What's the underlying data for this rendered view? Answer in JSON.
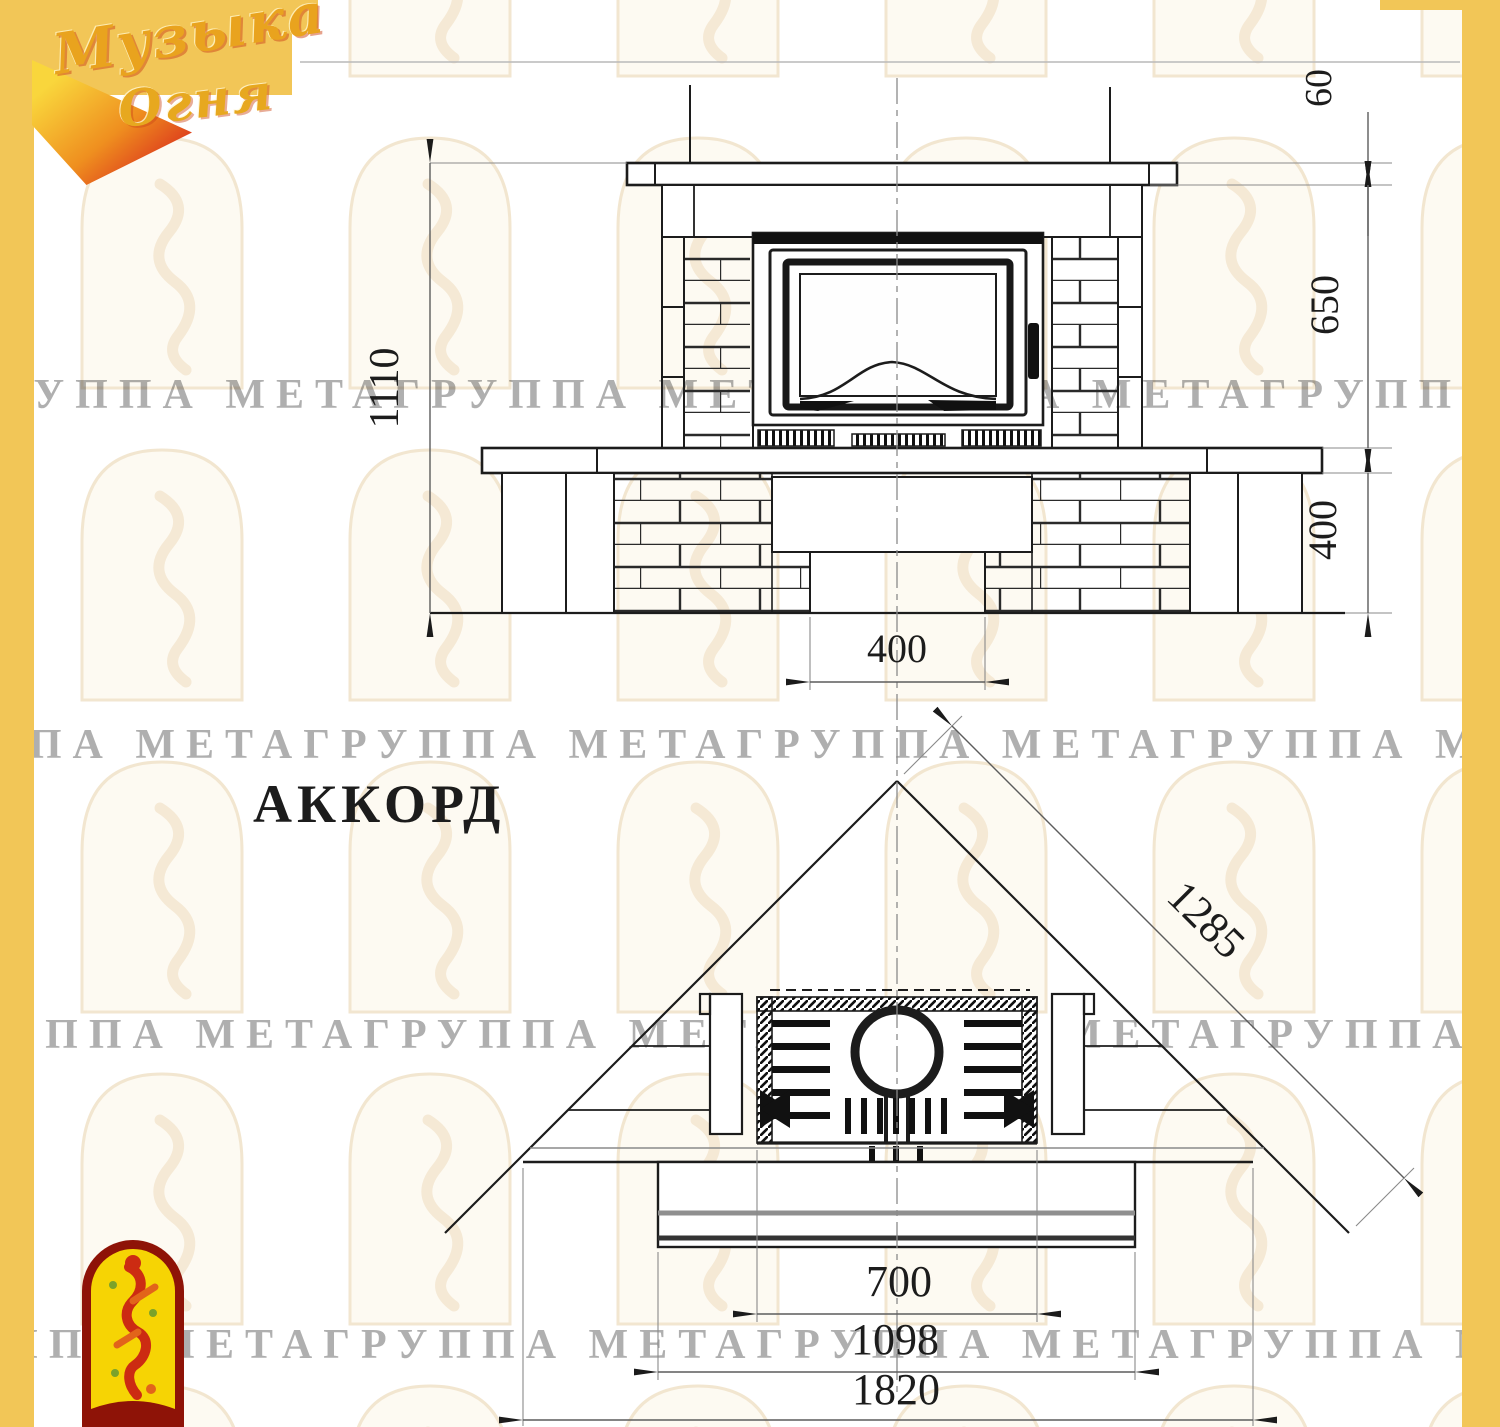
{
  "branding": {
    "logo_line1": "Музыка",
    "logo_line2": "Огня"
  },
  "title": "АККОРД",
  "watermark_text": "ГРУППА МЕТАГРУППА МЕТАГРУППА МЕТАГРУППА МЕТА",
  "colors": {
    "accent_yellow": "#F2C657",
    "drawing_line": "#1c1c1c",
    "dimension_line": "#5c5c5c",
    "watermark_tint": "#c9a37c",
    "emblem_border_red": "#8e1307",
    "emblem_yellow": "#f6d404",
    "flame_red": "#cc2b12"
  },
  "dimensions": {
    "front": {
      "total_height": "1110",
      "mantel_thickness": "60",
      "firebox_zone_height": "650",
      "base_height": "400",
      "niche_width": "400"
    },
    "plan": {
      "diagonal_depth": "1285",
      "firebox_width": "700",
      "base_width": "1098",
      "overall_width": "1820"
    }
  }
}
